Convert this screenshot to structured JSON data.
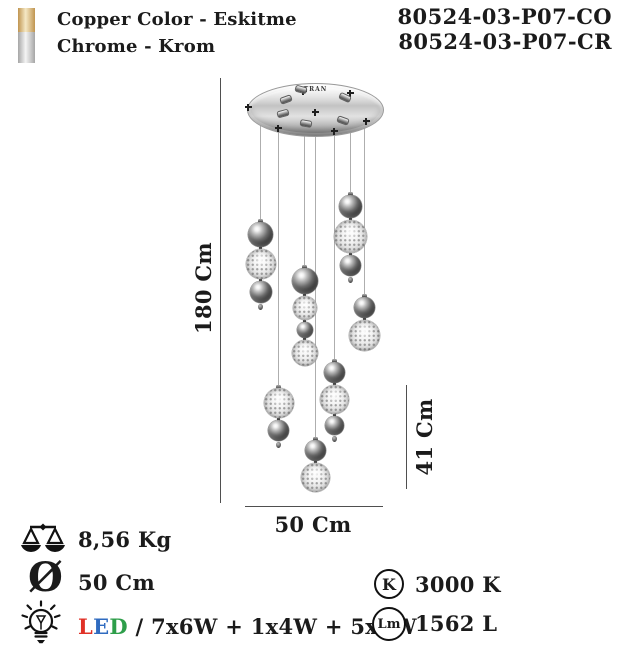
{
  "header": {
    "copper_label": "Copper Color - Eskitme",
    "chrome_label": "Chrome - Krom",
    "code_copper": "80524-03-P07-CO",
    "code_chrome": "80524-03-P07-CR",
    "copper_swatch_colors": [
      "#c09550",
      "#f5e8c5"
    ],
    "chrome_swatch_colors": [
      "#a6a6a6",
      "#f4f4f4"
    ]
  },
  "diagram": {
    "brand": "TRAN",
    "height_label": "180 Cm",
    "drop_label": "41 Cm",
    "width_label": "50 Cm",
    "canopy": {
      "cx": 314.5,
      "cy": 109,
      "rx": 67.5,
      "ry": 26
    },
    "pendants": [
      {
        "x": 260,
        "top": 222,
        "balls": [
          [
            "chrome",
            25
          ],
          [
            "glass",
            30
          ],
          [
            "chrome",
            22
          ]
        ],
        "tip": true
      },
      {
        "x": 278,
        "top": 388,
        "balls": [
          [
            "glass",
            30
          ],
          [
            "chrome",
            21
          ]
        ],
        "tip": true
      },
      {
        "x": 304,
        "top": 268,
        "balls": [
          [
            "chrome",
            26
          ],
          [
            "glass",
            24
          ],
          [
            "chrome",
            16
          ],
          [
            "glass",
            26
          ]
        ],
        "tip": false
      },
      {
        "x": 315,
        "top": 440,
        "balls": [
          [
            "chrome",
            21
          ],
          [
            "glass",
            29
          ]
        ],
        "tip": false
      },
      {
        "x": 334,
        "top": 362,
        "balls": [
          [
            "chrome",
            21
          ],
          [
            "glass",
            29
          ],
          [
            "chrome",
            19
          ]
        ],
        "tip": true
      },
      {
        "x": 350,
        "top": 195,
        "balls": [
          [
            "chrome",
            23
          ],
          [
            "glass",
            33
          ],
          [
            "chrome",
            21
          ]
        ],
        "tip": true
      },
      {
        "x": 364,
        "top": 297,
        "balls": [
          [
            "chrome",
            21
          ],
          [
            "glass",
            31
          ]
        ],
        "tip": false
      }
    ],
    "plus_marks": [
      [
        248,
        107
      ],
      [
        278,
        128
      ],
      [
        303,
        91
      ],
      [
        315,
        112
      ],
      [
        334,
        131
      ],
      [
        350,
        93
      ],
      [
        366,
        121
      ]
    ],
    "screws": [
      [
        285,
        98,
        -20
      ],
      [
        300,
        88,
        15
      ],
      [
        344,
        96,
        25
      ],
      [
        282,
        112,
        -15
      ],
      [
        305,
        122,
        10
      ],
      [
        342,
        119,
        20
      ]
    ]
  },
  "specs": {
    "weight": "8,56 Kg",
    "diameter_symbol": "Ø",
    "diameter": "50 Cm",
    "led_letters": [
      {
        "ch": "L",
        "color": "#e03127"
      },
      {
        "ch": "E",
        "color": "#2f6bc0"
      },
      {
        "ch": "D",
        "color": "#2e9e4a"
      }
    ],
    "led_suffix": " / 7x6W + 1x4W + 5x5W",
    "kelvin_badge": "K",
    "kelvin_value": "3000 K",
    "lumen_badge": "Lm",
    "lumen_value": "1562 L"
  }
}
